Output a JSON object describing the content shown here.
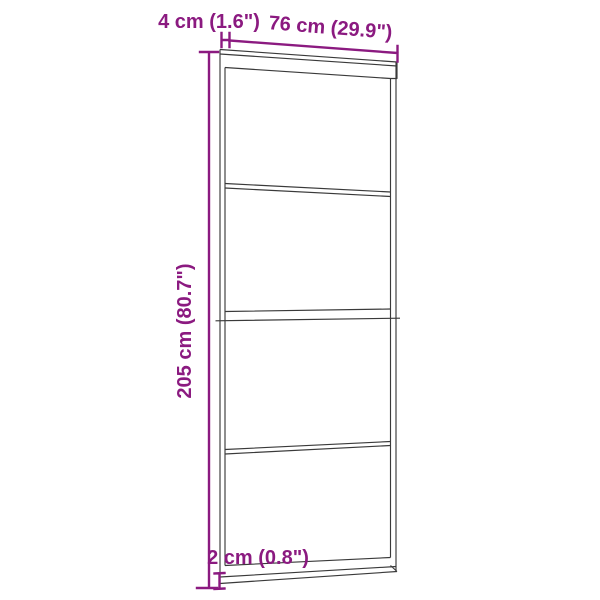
{
  "diagram": {
    "labels": {
      "track_width": "4 cm (1.6\")",
      "door_width": "76 cm (29.9\")",
      "door_height": "205 cm (80.7\")",
      "bottom_rail_height": "2 cm (0.8\")"
    },
    "colors": {
      "dimension_accent": "#8B1A80",
      "door_line": "#3A3A3A",
      "background": "#FFFFFF"
    }
  }
}
